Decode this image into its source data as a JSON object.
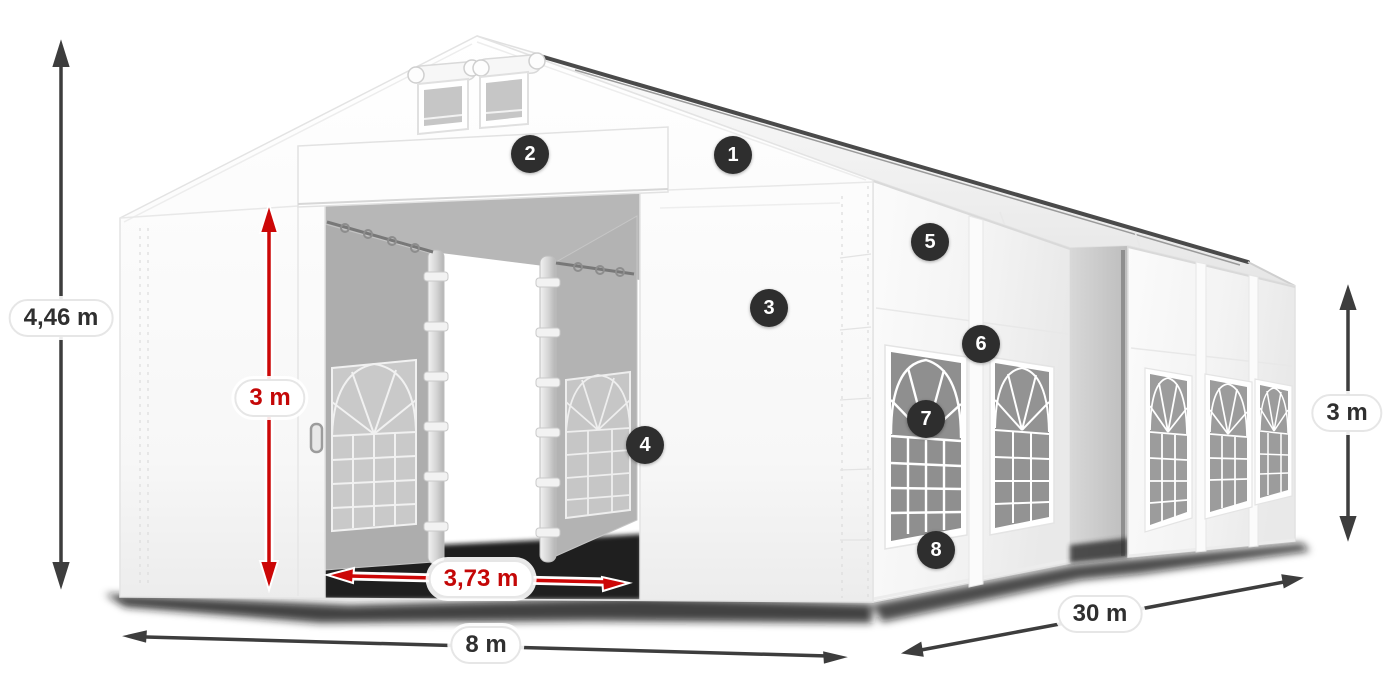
{
  "figure": {
    "type": "product-dimension-diagram",
    "subject": "large marquee storage tent with open entrance and arched windows"
  },
  "dimensions": {
    "total_height": "4,46 m",
    "entrance_height": "3 m",
    "entrance_width": "3,73 m",
    "gable_width": "8 m",
    "length": "30 m",
    "side_wall_height": "3 m"
  },
  "part_markers": [
    "1",
    "2",
    "3",
    "4",
    "5",
    "6",
    "7",
    "8"
  ],
  "colors": {
    "dimension_arrow": "#3d3d3d",
    "highlight_arrow": "#cc0707",
    "highlight_label_text": "#c40707",
    "label_text": "#2f2f2f",
    "marker_background": "#2e2e2e",
    "marker_text": "#ffffff",
    "background": "#ffffff"
  }
}
